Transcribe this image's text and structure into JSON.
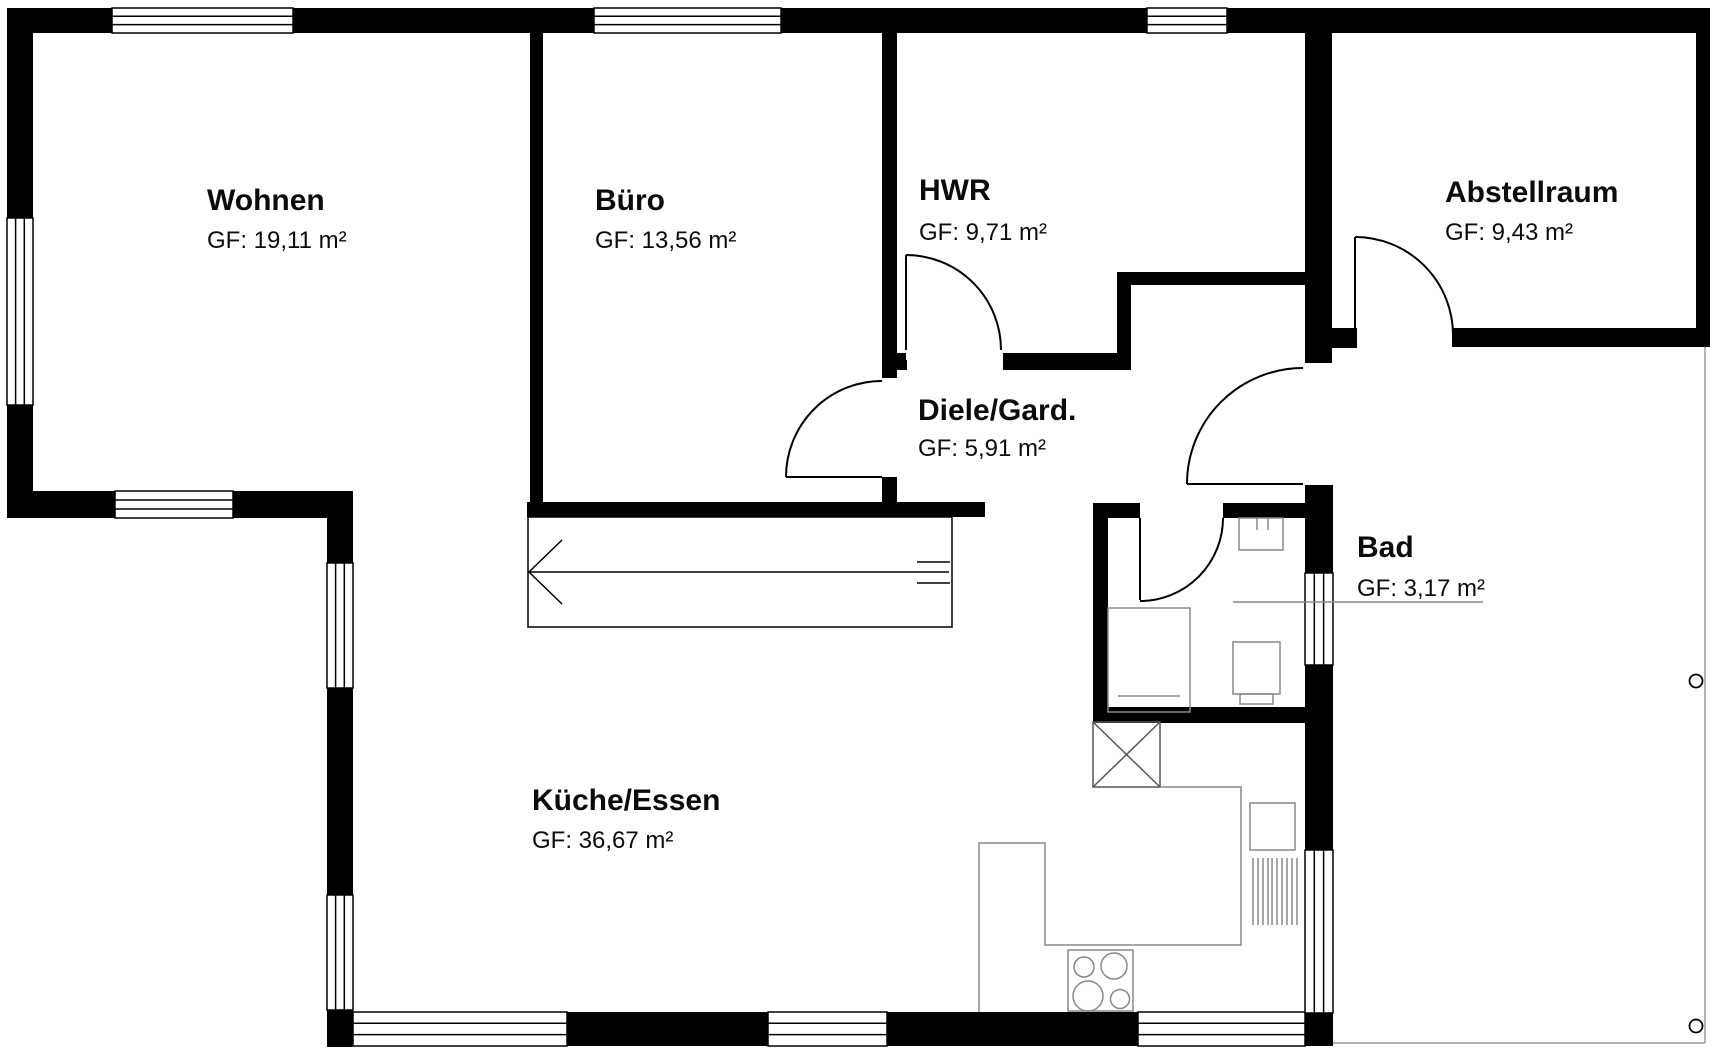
{
  "plan": {
    "type": "floorplan",
    "rooms": [
      {
        "name": "Wohnen",
        "area": "GF: 19,11 m²"
      },
      {
        "name": "Büro",
        "area": "GF: 13,56 m²"
      },
      {
        "name": "HWR",
        "area": "GF: 9,71 m²"
      },
      {
        "name": "Abstellraum",
        "area": "GF: 9,43 m²"
      },
      {
        "name": "Diele/Gard.",
        "area": "GF: 5,91 m²"
      },
      {
        "name": "Bad",
        "area": "GF: 3,17 m²"
      },
      {
        "name": "Küche/Essen",
        "area": "GF: 36,67 m²"
      }
    ],
    "colors": {
      "wall": "#000000",
      "fixture": "#888888",
      "background": "#ffffff"
    }
  }
}
